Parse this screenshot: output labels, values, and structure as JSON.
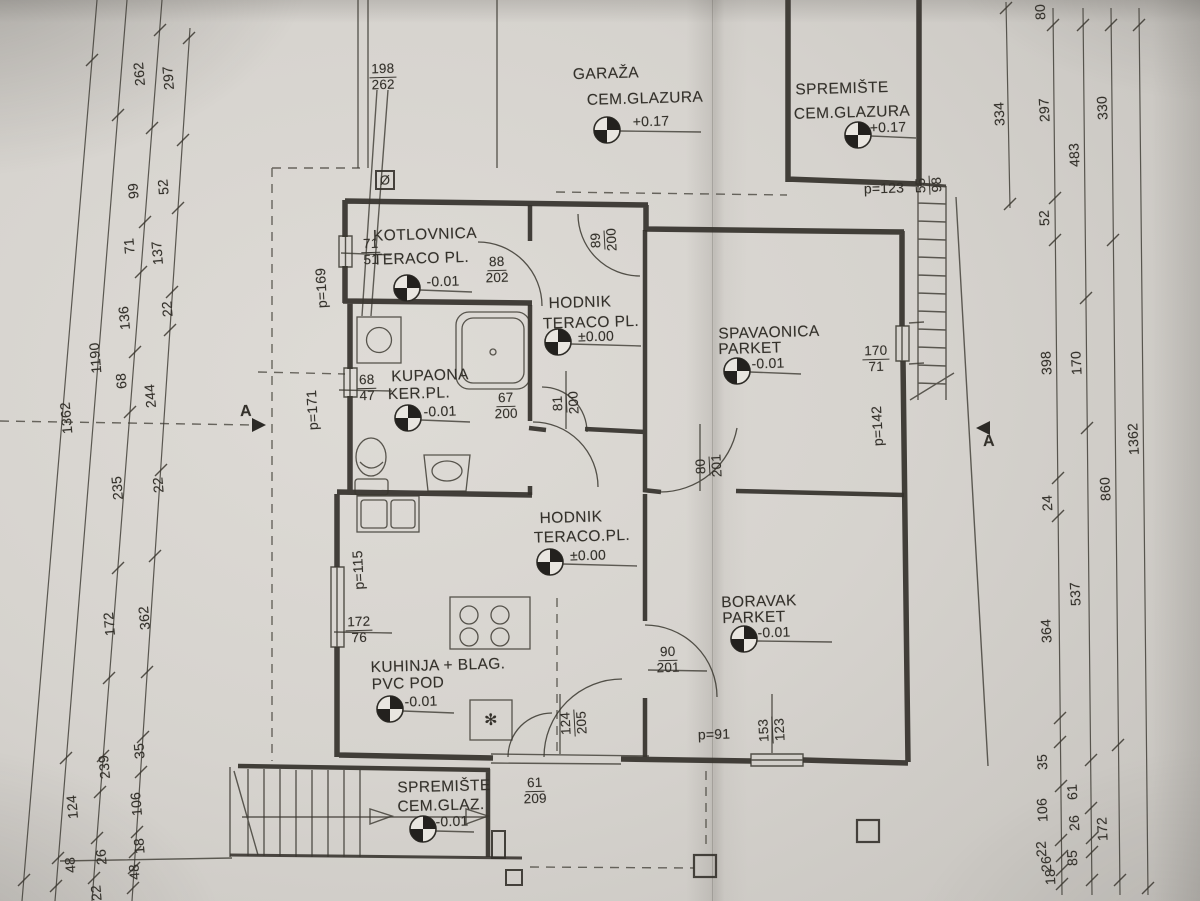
{
  "icons": {
    "diameter": "Ø",
    "snowflake": "✻"
  },
  "section": {
    "label": "A"
  },
  "rooms": {
    "garaza": {
      "name": "GARAŽA",
      "floor": "CEM.GLAZURA",
      "elev": "+0.17"
    },
    "spremiste_gornje": {
      "name": "SPREMIŠTE",
      "floor": "CEM.GLAZURA",
      "elev": "+0.17"
    },
    "kotlovnica": {
      "name": "KOTLOVNICA",
      "floor": "TERACO PL.",
      "elev": "-0.01"
    },
    "hodnik_gornji": {
      "name": "HODNIK",
      "floor": "TERACO PL.",
      "elev": "±0.00"
    },
    "kupaona": {
      "name": "KUPAONA",
      "floor": "KER.PL.",
      "elev": "-0.01"
    },
    "spavaonica": {
      "name": "SPAVAONICA",
      "floor": "PARKET",
      "elev": "-0.01"
    },
    "hodnik_donji": {
      "name": "HODNIK",
      "floor": "TERACO.PL.",
      "elev": "±0.00"
    },
    "kuhinja": {
      "name": "KUHINJA + BLAG.",
      "floor": "PVC POD",
      "elev": "-0.01"
    },
    "boravak": {
      "name": "BORAVAK",
      "floor": "PARKET",
      "elev": "-0.01"
    },
    "spremiste_donje": {
      "name": "SPREMIŠTE",
      "floor": "CEM.GLAZ.",
      "elev": "-0.01"
    }
  },
  "openings": {
    "garage_window": {
      "n": "198",
      "d": "262"
    },
    "stair_window": {
      "n": "55",
      "d": "98"
    },
    "kotlovnica_window": {
      "n": "71",
      "d": "51"
    },
    "kotlovnica_vrata": {
      "n": "88",
      "d": "202"
    },
    "hodnik_vrata": {
      "n": "89",
      "d": "200"
    },
    "kupaona_window": {
      "n": "68",
      "d": "47"
    },
    "kupaona_vrata": {
      "n": "67",
      "d": "200"
    },
    "hodnik_vrata2": {
      "n": "81",
      "d": "200"
    },
    "spavaonica_window": {
      "n": "170",
      "d": "71"
    },
    "spavaonica_vrata": {
      "n": "80",
      "d": "201"
    },
    "boravak_vrata": {
      "n": "90",
      "d": "201"
    },
    "boravak_window": {
      "n": "153",
      "d": "123"
    },
    "kuhinja_window": {
      "n": "172",
      "d": "76"
    },
    "ulaz_vrata": {
      "n": "124",
      "d": "205"
    },
    "spremiste_vrata": {
      "n": "61",
      "d": "209"
    }
  },
  "parapets": {
    "garaza": "p=123",
    "kotlovnica": "p=169",
    "kupaona": "p=171",
    "kuhinja": "p=115",
    "spavaonica": "p=142",
    "boravak": "p=91"
  },
  "dims_left": [
    "262",
    "297",
    "99",
    "52",
    "71",
    "137",
    "136",
    "68",
    "1190",
    "1362",
    "244",
    "22",
    "235",
    "22",
    "362",
    "172",
    "35",
    "239",
    "106",
    "124",
    "26",
    "48",
    "18",
    "48",
    "22"
  ],
  "dims_right": [
    "80",
    "334",
    "330",
    "297",
    "483",
    "52",
    "398",
    "170",
    "1362",
    "860",
    "24",
    "537",
    "364",
    "35",
    "61",
    "106",
    "26",
    "172",
    "85",
    "22",
    "26",
    "18"
  ]
}
